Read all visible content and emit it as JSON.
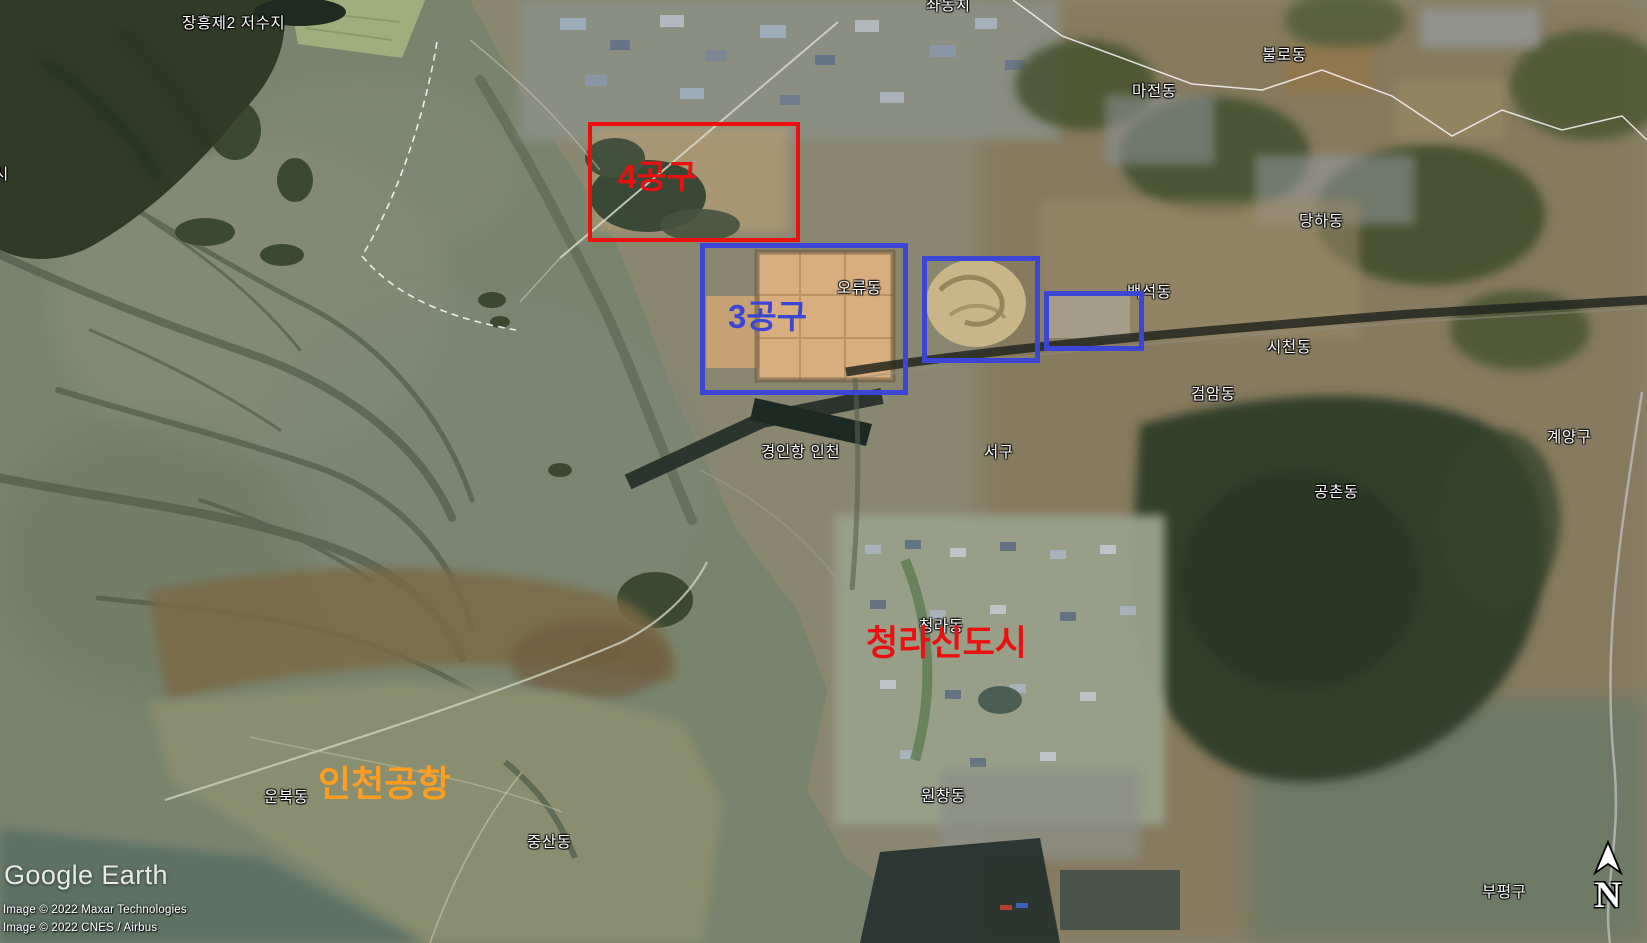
{
  "branding": {
    "logo_text": "Google Earth",
    "attribution_line1": "Image © 2022 Maxar Technologies",
    "attribution_line2": "Image © 2022 CNES / Airbus"
  },
  "compass": {
    "north_label": "N"
  },
  "annotations": {
    "colors": {
      "red": "#ea1010",
      "blue": "#3b46d5",
      "orange": "#ff9d21"
    },
    "boxes": [
      {
        "name": "section-4",
        "label": "4공구"
      },
      {
        "name": "section-3",
        "label": "3공구"
      },
      {
        "name": "golf-site",
        "label": ""
      },
      {
        "name": "small-site",
        "label": ""
      }
    ],
    "texts": [
      {
        "name": "cheongna-new-town",
        "text": "청라신도시"
      },
      {
        "name": "incheon-airport",
        "text": "인천공항"
      }
    ]
  },
  "place_labels": [
    {
      "text": "장흥제2 저수지"
    },
    {
      "text": "좌동치"
    },
    {
      "text": "불로동"
    },
    {
      "text": "마전동"
    },
    {
      "text": "당하동"
    },
    {
      "text": "백석동"
    },
    {
      "text": "오류동"
    },
    {
      "text": "시천동"
    },
    {
      "text": "검암동"
    },
    {
      "text": "서구"
    },
    {
      "text": "경인항 인천"
    },
    {
      "text": "계양구"
    },
    {
      "text": "공촌동"
    },
    {
      "text": "청라동"
    },
    {
      "text": "원창동"
    },
    {
      "text": "운북동"
    },
    {
      "text": "중산동"
    },
    {
      "text": "부평구"
    },
    {
      "text": "시"
    }
  ]
}
